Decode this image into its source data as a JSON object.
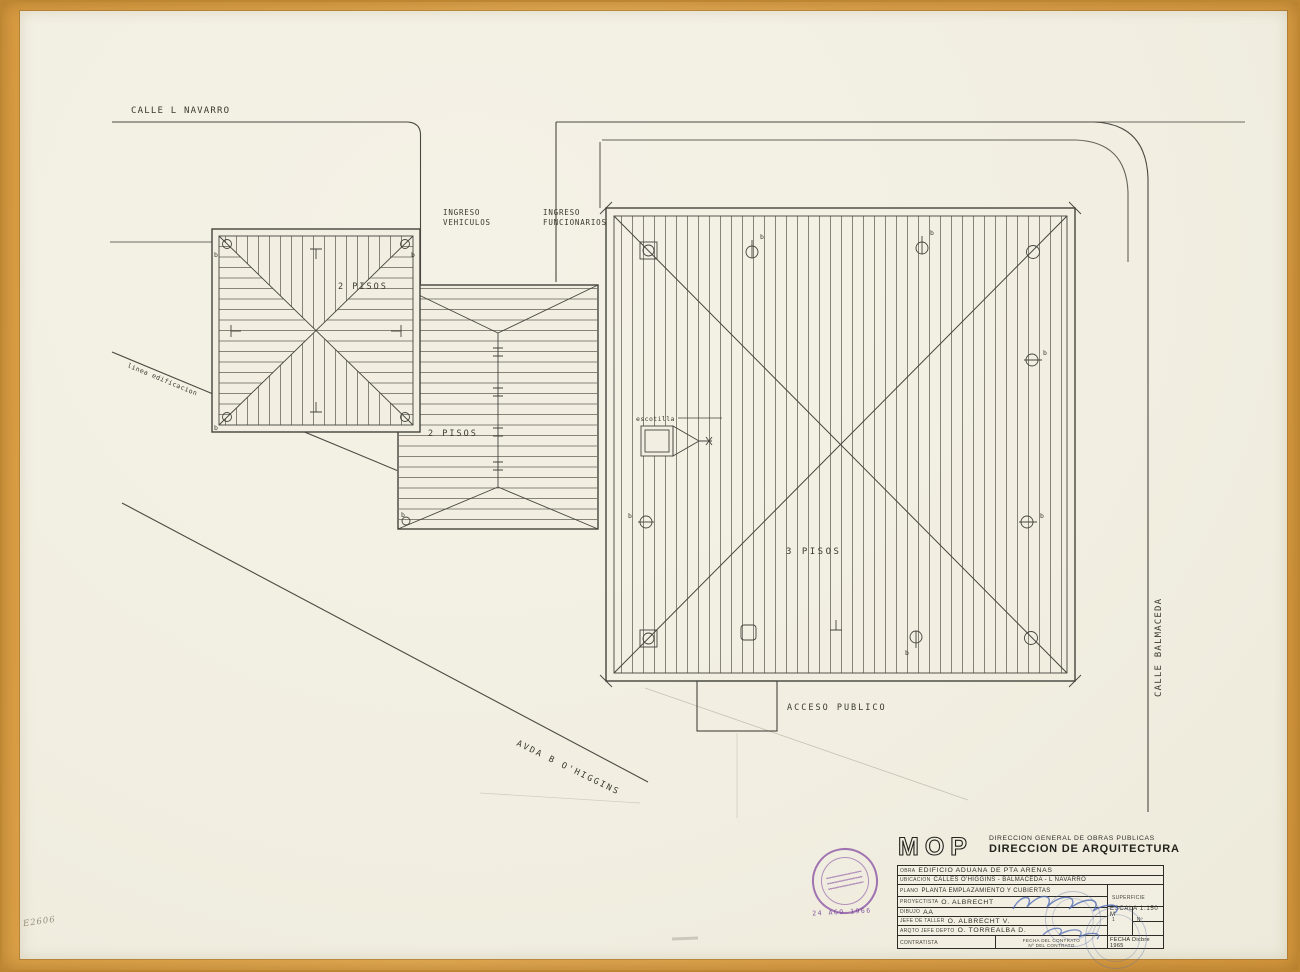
{
  "colors": {
    "paper": "#f2efe2",
    "ink": "#4a4942",
    "frame_orange": "#dda04a",
    "stamp_purple": "#7d3f9c",
    "signature_blue": "#4f6cb4"
  },
  "streets": {
    "calle_navarro": "CALLE  L NAVARRO",
    "calle_balmaceda": "CALLE  BALMACEDA",
    "avda_ohiggins": "AVDA  B O'HIGGINS",
    "linea_edificacion": "linea edificacion"
  },
  "site": {
    "ingreso_vehiculos_1": "INGRESO",
    "ingreso_vehiculos_2": "VEHICULOS",
    "ingreso_funcionarios_1": "INGRESO",
    "ingreso_funcionarios_2": "FUNCIONARIOS",
    "building_a_label": "2 PISOS",
    "building_b_label": "2 PISOS",
    "building_c_label": "3 PISOS",
    "acceso_publico": "ACCESO  PUBLICO",
    "escotilla": "escotilla",
    "fixture_b": "b"
  },
  "title_block": {
    "logo": "MOP",
    "agency_line1": "DIRECCION GENERAL DE OBRAS PUBLICAS",
    "agency_line2": "DIRECCION DE ARQUITECTURA",
    "obra_label": "OBRA",
    "obra_value": "EDIFICIO ADUANA DE PTA ARENAS",
    "ubicacion_label": "UBICACION",
    "ubicacion_value": "CALLES O'HIGGINS - BALMACEDA - L NAVARRO",
    "plano_label": "PLANO",
    "plano_value": "PLANTA EMPLAZAMIENTO Y CUBIERTAS",
    "superficie_label": "SUPERFICIE",
    "escala_value": "ESCALA 1:150 M",
    "proyectista_label": "PROYECTISTA",
    "proyectista_value": "O. ALBRECHT",
    "dibujo_label": "DIBUJO",
    "dibujo_value": "AA",
    "jefe_taller_label": "JEFE DE TALLER",
    "jefe_taller_value": "O. ALBRECHT V.",
    "arqto_label": "ARQTO JEFE DEPTO",
    "arqto_value": "O. TORREALBA D.",
    "contratista_label": "CONTRATISTA",
    "fecha_contrato_label": "FECHA DEL CONTRATO",
    "num_contrato_label": "Nº DEL CONTRATO",
    "sheet_cell": "1",
    "num_cell": "Nº",
    "fecha_value": "FECHA Dicbre 1965"
  },
  "stamps": {
    "received_date": "24 AGO 1966"
  },
  "notes": {
    "pencil_note": "E2606"
  }
}
